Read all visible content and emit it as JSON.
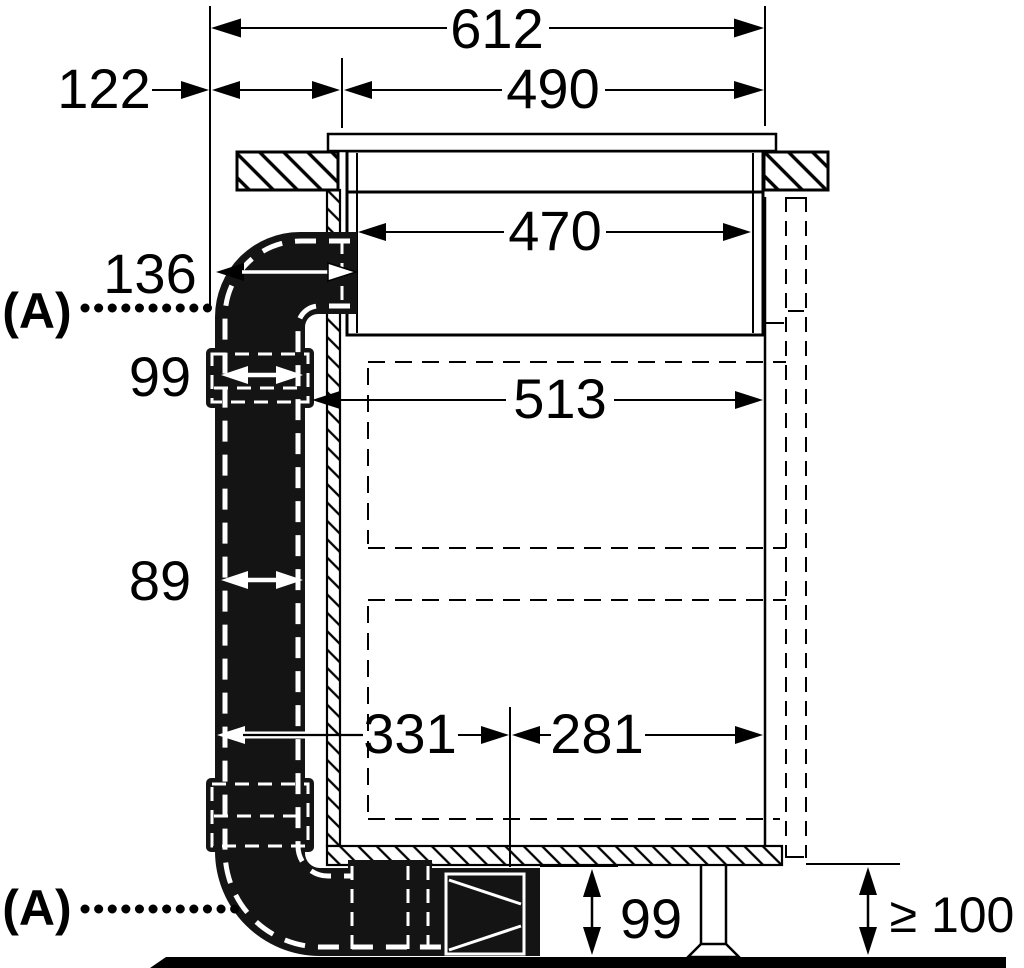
{
  "drawing": {
    "description": "appliance installation side-view dimension drawing",
    "colors": {
      "line": "#000000",
      "duct": "#141414",
      "background": "#ffffff"
    },
    "labels": {
      "total_width": "612",
      "cutout_width": "490",
      "left_offset": "122",
      "appliance_inner_width": "470",
      "duct_elbow_depth": "136",
      "duct_connector_width": "99",
      "cabinet_clearance_width": "513",
      "duct_width": "89",
      "duct_run_left": "331",
      "duct_run_right": "281",
      "plinth_duct_height": "99",
      "min_plinth_height": "≥ 100",
      "accessory_marker_top": "(A)",
      "accessory_marker_bottom": "(A)"
    }
  }
}
